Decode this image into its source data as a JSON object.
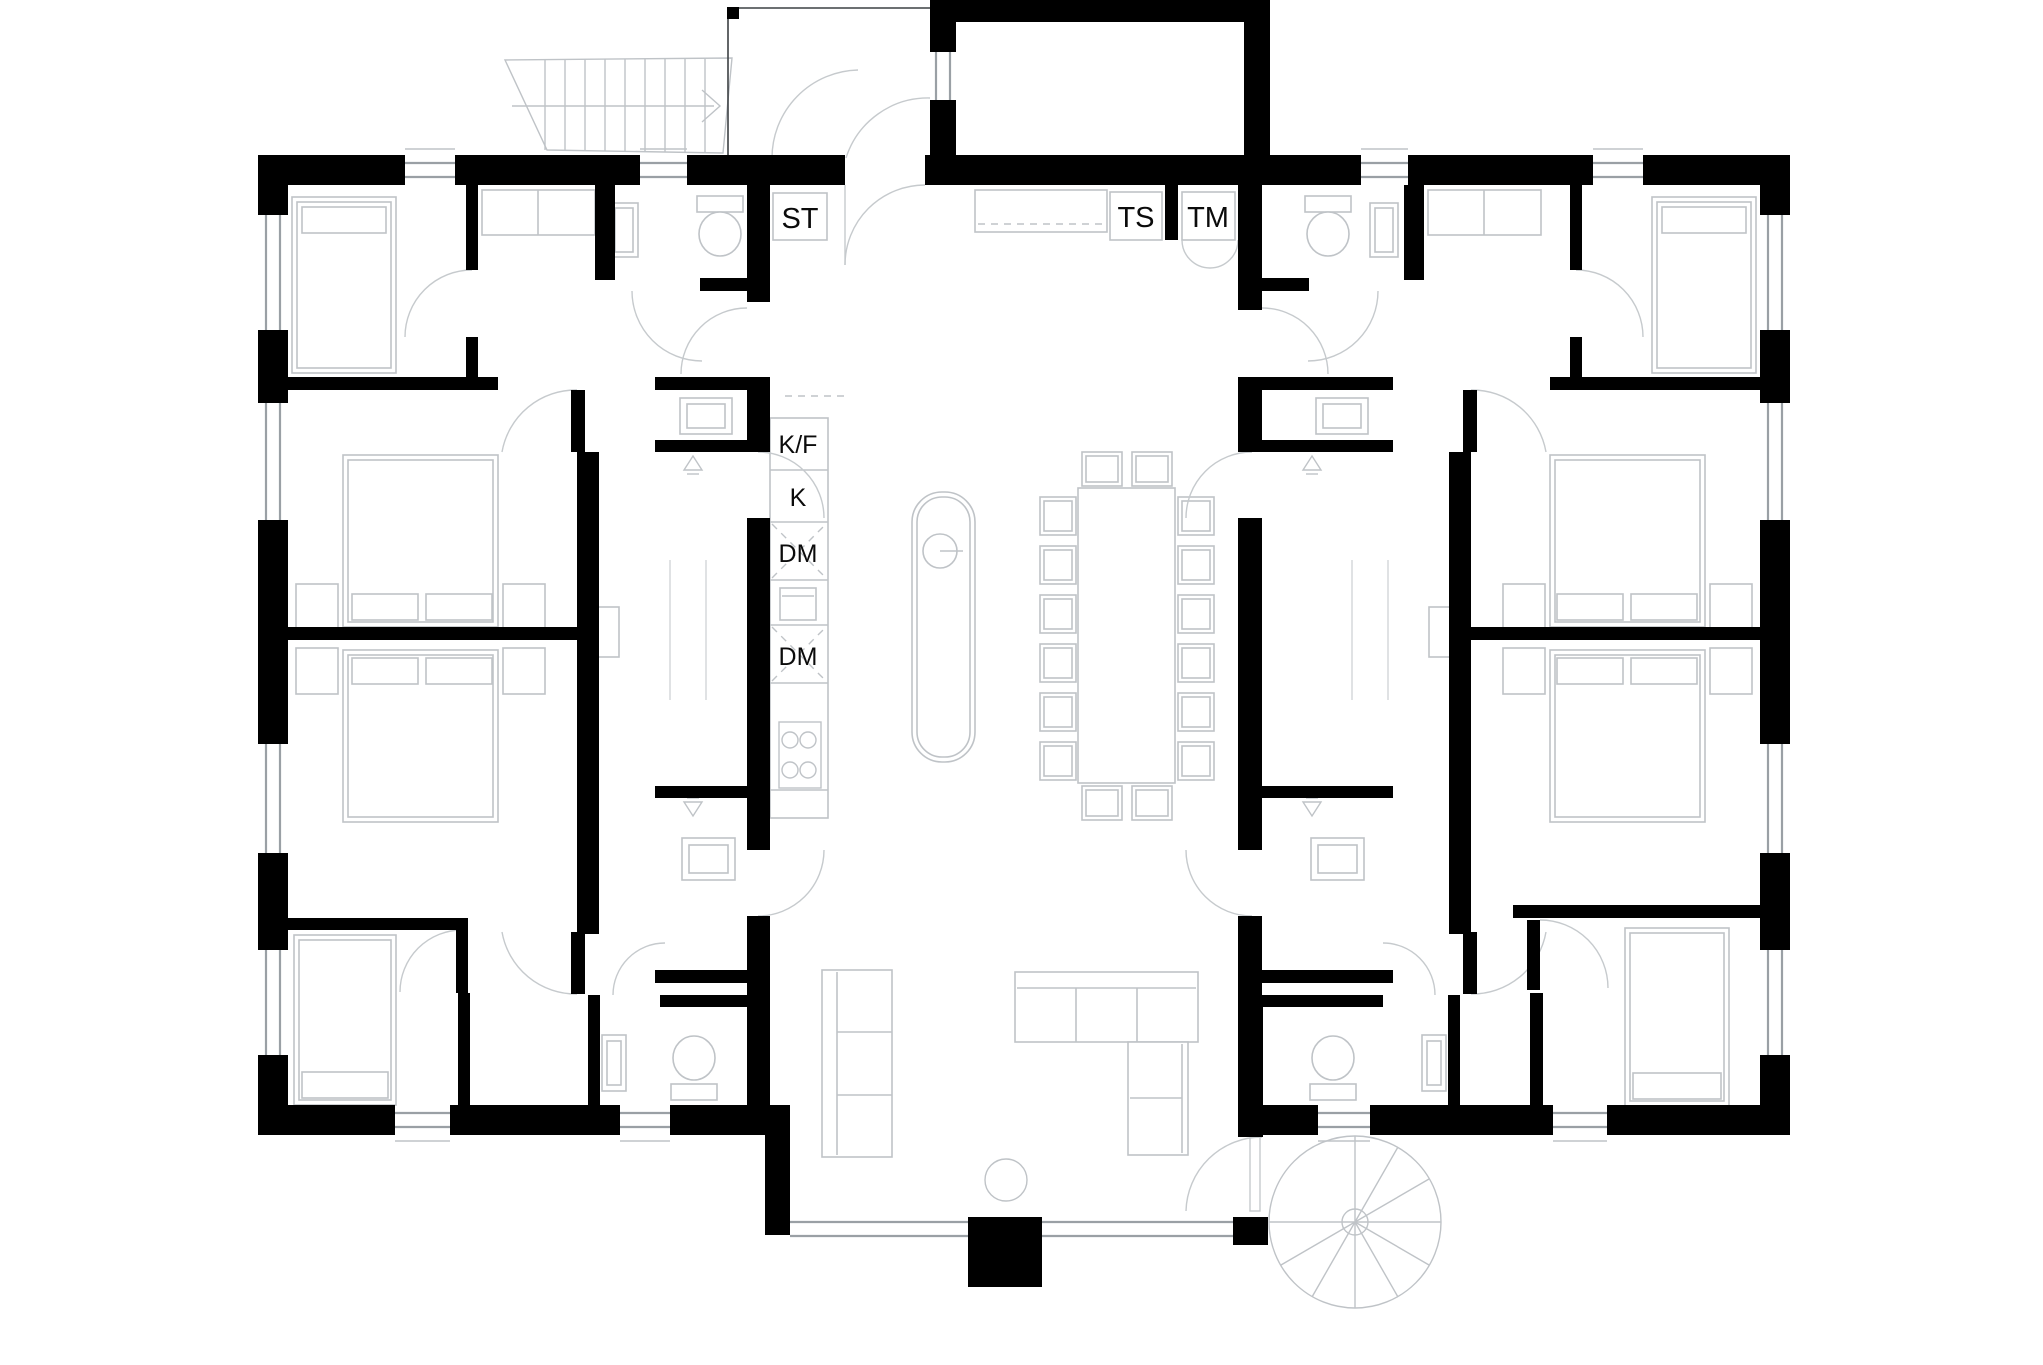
{
  "plan": {
    "labels": {
      "st": "ST",
      "ts": "TS",
      "tm": "TM",
      "kf": "K/F",
      "k": "K",
      "dm_upper": "DM",
      "dm_lower": "DM"
    },
    "colors": {
      "wall": "#000000",
      "furniture_line": "#bfc3c7",
      "window_line": "#9aa0a5",
      "door_arc": "#c6cacd",
      "background": "#ffffff",
      "label_text": "#0b0b0b"
    },
    "fixtures": [
      "double-bed",
      "single-bed",
      "pillow",
      "nightstand",
      "wardrobe",
      "toilet",
      "washbasin",
      "shower-drain",
      "shower-glass",
      "shower-panel",
      "fridge-freezer",
      "fridge",
      "dishwasher",
      "oven",
      "cooktop",
      "kitchen-island",
      "island-sink",
      "dining-table",
      "dining-chair",
      "sofa",
      "corner-sofa",
      "coffee-table",
      "laundry-counter",
      "drying-cabinet",
      "washing-machine",
      "cleaning-closet",
      "external-staircase",
      "spiral-staircase",
      "chimney",
      "window",
      "door"
    ]
  }
}
